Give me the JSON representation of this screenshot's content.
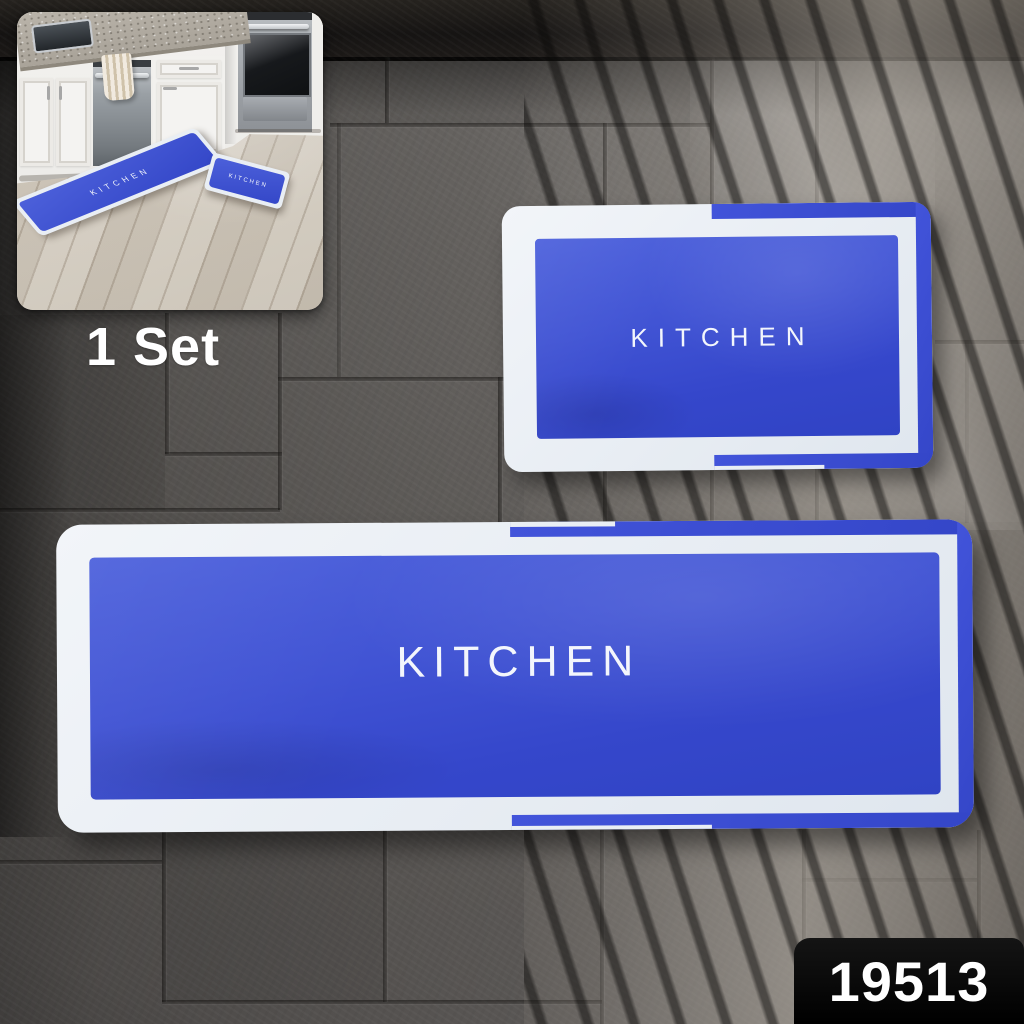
{
  "labels": {
    "set_count": "1 Set",
    "mat_text": "KITCHEN",
    "product_code": "19513"
  },
  "colors": {
    "mat_blue": "#3f53d4",
    "mat_blue_deep": "#3144c6",
    "mat_border_white": "#e9eef4",
    "tile_gray": "#5e5b58",
    "grout_gray": "#2b2927",
    "countertop_dark": "#1e1c1a",
    "wood_floor": "#d6cfc3",
    "badge_background": "#0a0a0a",
    "text_white": "#ffffff"
  }
}
